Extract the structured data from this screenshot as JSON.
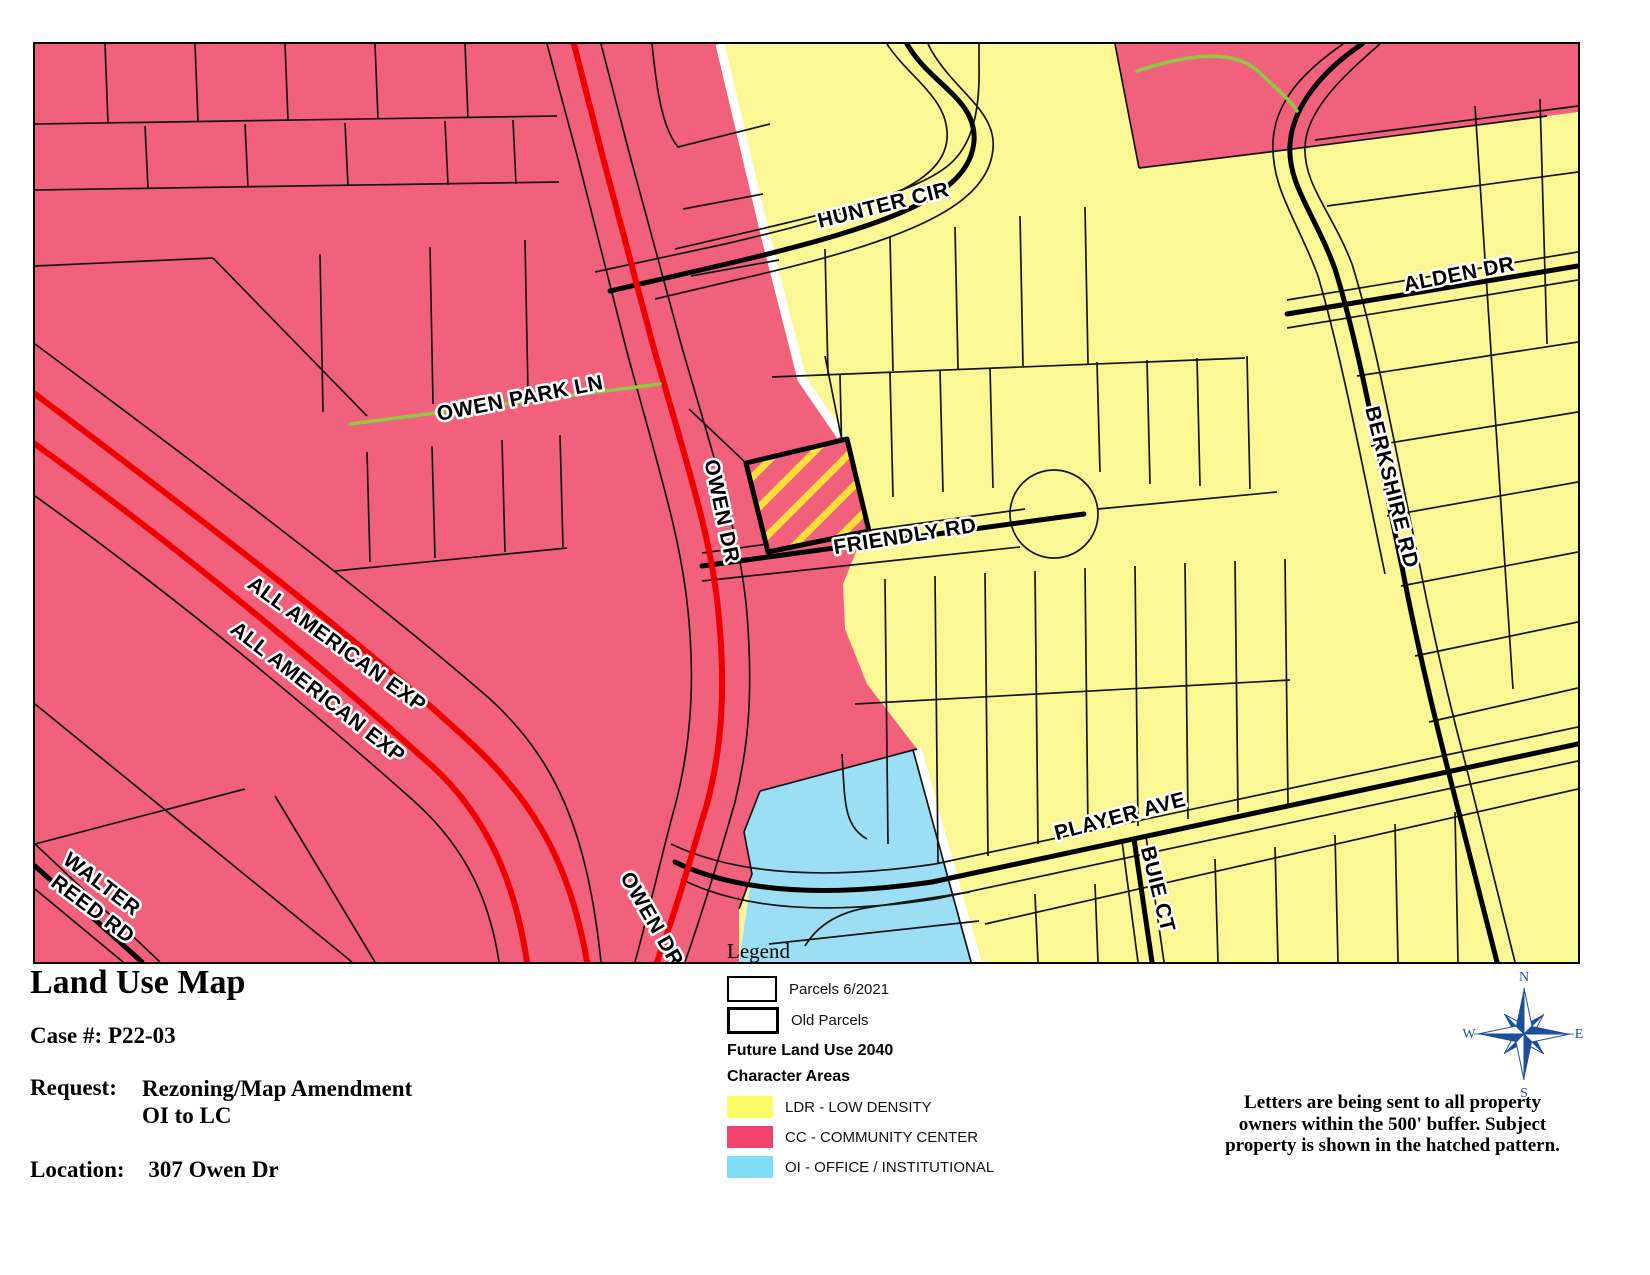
{
  "title_block": {
    "title": "Land Use Map",
    "case_label": "Case #:",
    "case_value": "P22-03",
    "request_label": "Request:",
    "request_line1": "Rezoning/Map Amendment",
    "request_line2": "OI to LC",
    "location_label": "Location:",
    "location_value": "307 Owen Dr"
  },
  "legend": {
    "heading": "Legend",
    "parcel_items": [
      {
        "label": "Parcels 6/2021"
      },
      {
        "label": "Old Parcels"
      }
    ],
    "section_heading": "Future Land Use 2040",
    "subsection_heading": "Character Areas",
    "character_areas": [
      {
        "label": "LDR - LOW DENSITY",
        "color": "#FCFC66"
      },
      {
        "label": "CC - COMMUNITY CENTER",
        "color": "#F2416B"
      },
      {
        "label": "OI - OFFICE / INSTITUTIONAL",
        "color": "#80DFF8"
      }
    ]
  },
  "note": {
    "line1": "Letters are being sent to all property",
    "line2": "owners within the 500' buffer.  Subject",
    "line3": "property is shown in the hatched pattern."
  },
  "compass": {
    "n": "N",
    "s": "S",
    "e": "E",
    "w": "W",
    "color": "#1D4E9E"
  },
  "map": {
    "colors": {
      "ldr": "#FAF794",
      "cc": "#F2617C",
      "oi": "#9CDFF5",
      "red_road": "#EE0000",
      "green_road": "#8CCB42",
      "hatch_yellow": "#FFDF3A"
    },
    "street_labels": [
      {
        "name": "hunter-cir",
        "text": "HUNTER CIR"
      },
      {
        "name": "owen-park-ln",
        "text": "OWEN PARK LN"
      },
      {
        "name": "owen-dr-upper",
        "text": "OWEN DR"
      },
      {
        "name": "friendly-rd",
        "text": "FRIENDLY RD"
      },
      {
        "name": "alden-dr",
        "text": "ALDEN DR"
      },
      {
        "name": "berkshire-rd",
        "text": "BERKSHIRE RD"
      },
      {
        "name": "all-american-exp-a",
        "text": "ALL AMERICAN EXP"
      },
      {
        "name": "all-american-exp-b",
        "text": "ALL AMERICAN EXP"
      },
      {
        "name": "player-ave",
        "text": "PLAYER AVE"
      },
      {
        "name": "buie-ct",
        "text": "BUIE CT"
      },
      {
        "name": "walter-reed-line1",
        "text": "WALTER"
      },
      {
        "name": "walter-reed-line2",
        "text": "REED RD"
      },
      {
        "name": "owen-dr-lower",
        "text": "OWEN DR"
      }
    ]
  }
}
